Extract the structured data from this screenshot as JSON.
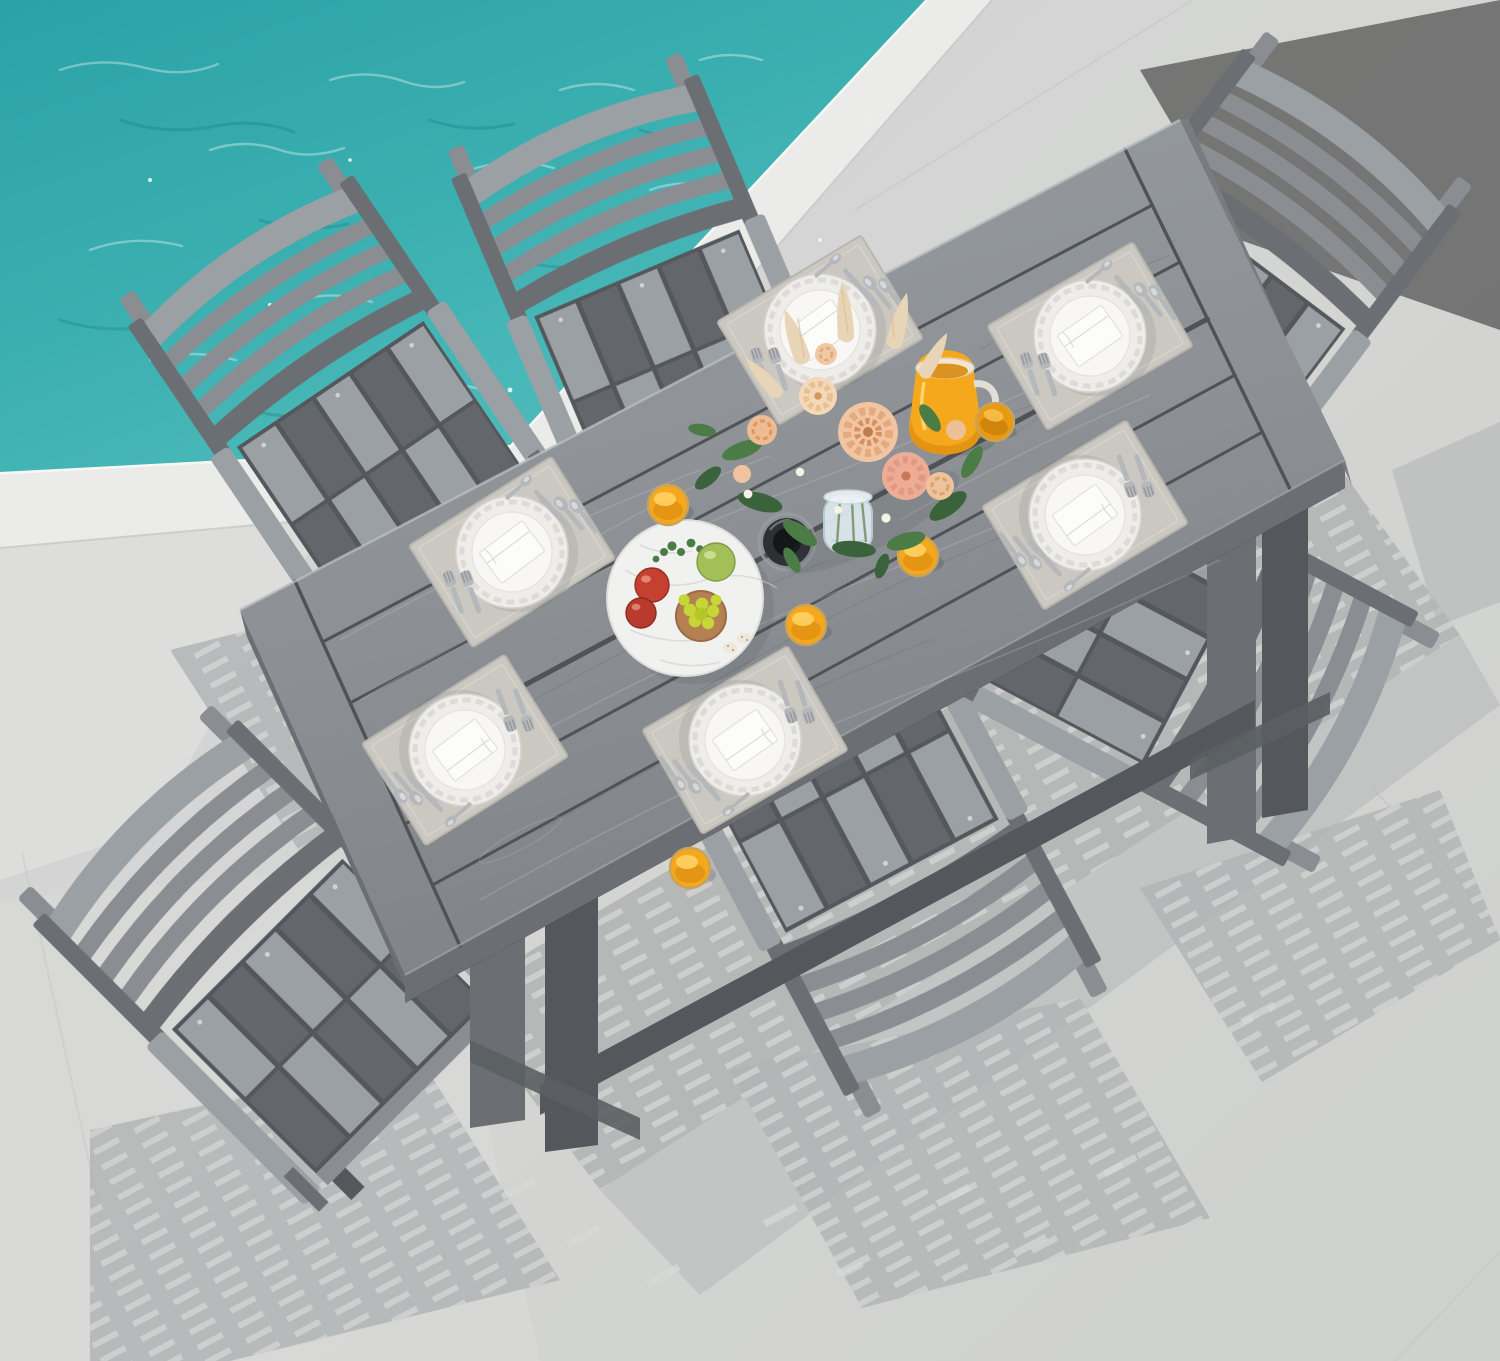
{
  "meta": {
    "description": "Overhead product photo of a 7-piece gray poly-lumber outdoor dining set: a rectangular wood-grain table with six slatted armchairs on a light concrete pool deck beside turquoise pool water. The table is set with six placemats with white scalloped plates, folded napkins and silverware, a peach flower bouquet in a glass vase, an orange-juice pitcher, orange-juice glasses, a fruit platter and a black umbrella-hole grommet."
  },
  "scene": {
    "pool": {
      "label": "turquoise pool water with ripples and sparkles"
    },
    "deck": {
      "coping": "white pool coping band",
      "floor": "light gray concrete patio with soft striped furniture shadows and faint joints"
    },
    "furniture": {
      "table": "rectangular slatted dining table with wood-grain texture, breadboard ends and center umbrella hole",
      "chair_count": 6,
      "chair_style": "slatted back with twin top horns, armrests, checkered two-tone seat slats"
    },
    "tabletop_items": {
      "place_setting_count": 6,
      "place_setting_parts": [
        "beige placemat",
        "scalloped charger plate",
        "dinner plate",
        "folded white napkin",
        "two forks",
        "knife",
        "spoons"
      ],
      "centerpiece": {
        "bouquet": [
          "peach dahlias",
          "roses",
          "pampas grass",
          "greenery"
        ],
        "vase": "clear glass vase"
      },
      "drinks": {
        "pitcher_count": 1,
        "pitcher": "glass pitcher of orange juice",
        "juice_glass_count": 5
      },
      "fruit_platter": [
        "red apples",
        "green apple",
        "yellow-green grapes in copper bowl",
        "parsley sprigs",
        "quail eggs"
      ],
      "umbrella_grommet_count": 1
    }
  },
  "colors": {
    "pool_deep": "#1f9296",
    "pool_mid": "#35aaac",
    "pool_light": "#5ec4c2",
    "sparkle": "#dcf7f1",
    "coping": "#ebecea",
    "coping_edge": "#f7f8f6",
    "concrete": "#d3d4d2",
    "concrete_light": "#dfe0de",
    "shadow": "#b2b5b5",
    "shadow_stripe": "#d8dad8",
    "wood_mid": "#8a8e92",
    "wood_light": "#9ba0a4",
    "wood_dark": "#6b6f73",
    "wood_deep": "#54585c",
    "seat_light": "#9aa0a4",
    "seat_dark": "#63676b",
    "table_top": "#8f9397",
    "plank_gap": "#4f5357",
    "grain_light": "#c3c7ca",
    "grain_dark": "#5e6266",
    "placemat": "#cbc8c1",
    "placemat_edge": "#b9b6af",
    "plate": "#efedea",
    "plate_inner": "#f8f7f5",
    "napkin": "#fcfcfa",
    "silver": "#b5b8bb",
    "silver_dark": "#8d9093",
    "juice": "#f6a81c",
    "juice_deep": "#d8880e",
    "juice_rim": "#c9a35a",
    "flower_peach": "#f2c5a2",
    "flower_pink": "#eeac96",
    "flower_cream": "#f4d8b8",
    "flower_core": "#c27a4e",
    "pampas": "#e8d4b6",
    "leaf": "#4c7c46",
    "leaf_dark": "#3a633c",
    "vase": "#dce8ee",
    "platter": "#f1f1ef",
    "marble": "#c9cbc9",
    "apple_red": "#c5402f",
    "apple_green": "#a3bf57",
    "grape": "#c6d636",
    "bowl_copper": "#b58052",
    "egg": "#efe8d8",
    "grommet": "#2e3134",
    "grommet_dark": "#141617"
  }
}
